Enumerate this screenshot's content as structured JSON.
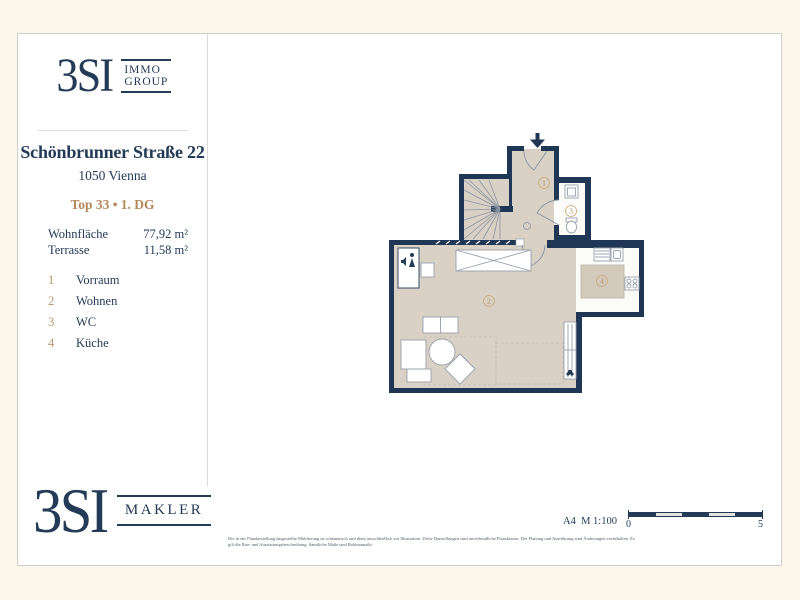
{
  "colors": {
    "navy": "#243b57",
    "wall_navy": "#203655",
    "gold": "#b4895a",
    "floor_beige": "#d9d1c5",
    "background_cream": "#faf6ea"
  },
  "header_logo": {
    "brand": "3SI",
    "line1": "IMMO",
    "line2": "GROUP"
  },
  "project": {
    "address": "Schönbrunner Straße 22",
    "city": "1050 Vienna",
    "unit": "Top 33 • 1. DG"
  },
  "areas": [
    {
      "label": "Wohnfläche",
      "value": "77,92 m²"
    },
    {
      "label": "Terrasse",
      "value": "11,58 m²"
    }
  ],
  "legend": [
    {
      "number": "1",
      "name": "Vorraum"
    },
    {
      "number": "2",
      "name": "Wohnen"
    },
    {
      "number": "3",
      "name": "WC"
    },
    {
      "number": "4",
      "name": "Küche"
    }
  ],
  "footer_logo": {
    "brand": "3SI",
    "line1": "MAKLER"
  },
  "footer": {
    "format_scale": "A4  M 1:100",
    "scale_start": "0",
    "scale_end": "5",
    "disclaimer_line1": "Die in der Plandarstellung dargestellte Möblierung ist schematisch und dient ausschließlich zur Illustration. Diese Darstellungen sind unverbindliche Planskizzen. Der Planung und Ausführung sind Änderungen vorbehalten. Es",
    "disclaimer_line2": "gilt die Bau- und Ausstattungsbeschreibung. Sämtliche Maße sind Rohbaumaße."
  }
}
